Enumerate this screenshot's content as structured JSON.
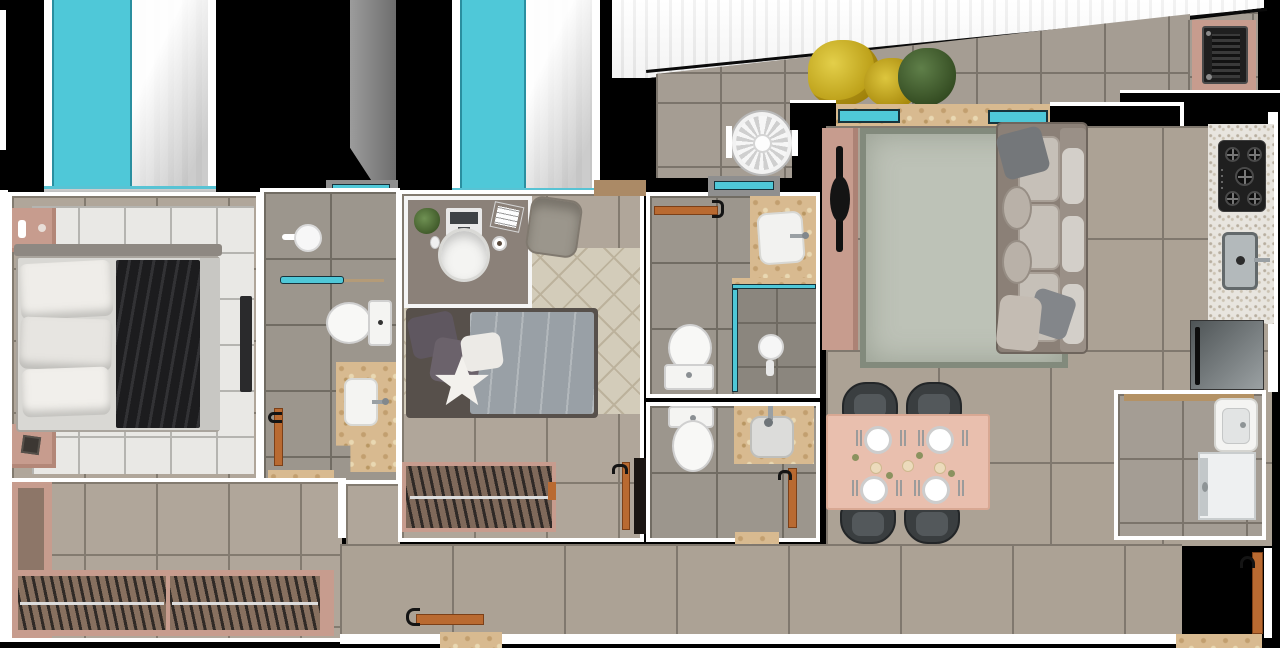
{
  "meta": {
    "description": "Top-down 3D rendered architectural floor plan of an apartment, no text labels",
    "view": "top-down",
    "width_px": 1280,
    "height_px": 648
  },
  "colors": {
    "outside": "#000000",
    "wall_white": "#ffffff",
    "glass_cyan": "#4fc8d8",
    "door_orange": "#b96a31",
    "travertine": "#d8ba90",
    "pink_furniture": "#c79c8e",
    "dining_table": "#e9bfae",
    "closet_interior": "#87705f",
    "sofa_taupe": "#8b8077",
    "rug_living": "#bdc2b7",
    "rug_bedroom1": "#e9e8e5",
    "rug_bedroom2": "#d3ccba",
    "duvet_gray": "#99a0a6",
    "throw_black": "#1c1c1e",
    "chair_dark": "#3a3e40",
    "appliance_black": "#1f1f1f",
    "granite": "#e8e5df",
    "plant_yellow": "#c9ad2d",
    "plant_green": "#4e6b3b",
    "fridge_gray": "#6a7072",
    "shaft_gray": "#8c8c8c"
  },
  "rooms": [
    {
      "name": "master-bedroom",
      "furniture": [
        "double-bed",
        "pillows",
        "black-throw-blanket",
        "grid-area-rug",
        "nightstand-top",
        "nightstand-bottom",
        "table-lamp",
        "candle",
        "door-leaf",
        "floor-to-ceiling-window",
        "white-curtain"
      ]
    },
    {
      "name": "ensuite-bathroom",
      "furniture": [
        "toilet",
        "travertine-vanity",
        "sink-basin",
        "faucet",
        "towel-ring",
        "cyan-towel-bar",
        "door-leaf",
        "vent-window"
      ]
    },
    {
      "name": "closet-hallway",
      "furniture": [
        "wardrobe-left",
        "wardrobe-bottom",
        "clothes-hangers",
        "hanging-rods"
      ]
    },
    {
      "name": "bedroom-2",
      "furniture": [
        "desk",
        "laptop",
        "papers",
        "houseplant",
        "mouse",
        "mug",
        "desk-chair",
        "lounge-chair",
        "single-bed",
        "star-pillow",
        "diamond-area-rug",
        "closet-with-hangers",
        "door-leaf",
        "floor-to-ceiling-window",
        "white-curtain"
      ]
    },
    {
      "name": "bathroom-2",
      "furniture": [
        "toilet",
        "travertine-vanity",
        "sink-basin",
        "shower-enclosure",
        "glass-screen",
        "shower-head",
        "door-leaf",
        "vent-window"
      ]
    },
    {
      "name": "bathroom-3",
      "furniture": [
        "toilet",
        "travertine-vanity",
        "square-sink",
        "door-leaf",
        "travertine-threshold"
      ]
    },
    {
      "name": "living-dining-room",
      "furniture": [
        "sofa",
        "seat-cushions",
        "throw-pillows",
        "area-rug",
        "tv-console",
        "tv",
        "dining-table",
        "dining-chairs",
        "place-settings",
        "candles",
        "window-sill"
      ]
    },
    {
      "name": "kitchen",
      "furniture": [
        "granite-counter",
        "gas-cooktop-5-burner",
        "stainless-sink",
        "faucet",
        "refrigerator"
      ]
    },
    {
      "name": "laundry-room",
      "furniture": [
        "utility-sink",
        "washing-machine",
        "sliding-door-track"
      ]
    },
    {
      "name": "balcony-terrace",
      "furniture": [
        "barbecue-grill",
        "grill-counter",
        "yellow-plant",
        "green-plant",
        "condenser-fan",
        "diagonal-facade"
      ]
    },
    {
      "name": "entry",
      "furniture": [
        "entrance-door",
        "service-door",
        "travertine-threshold"
      ]
    }
  ],
  "counts": {
    "bedrooms": 2,
    "bathrooms": 3,
    "dining_chairs": 4,
    "place_settings": 4,
    "cooktop_burners": 5,
    "windows_cyan": 6,
    "doors_orange": 6
  }
}
